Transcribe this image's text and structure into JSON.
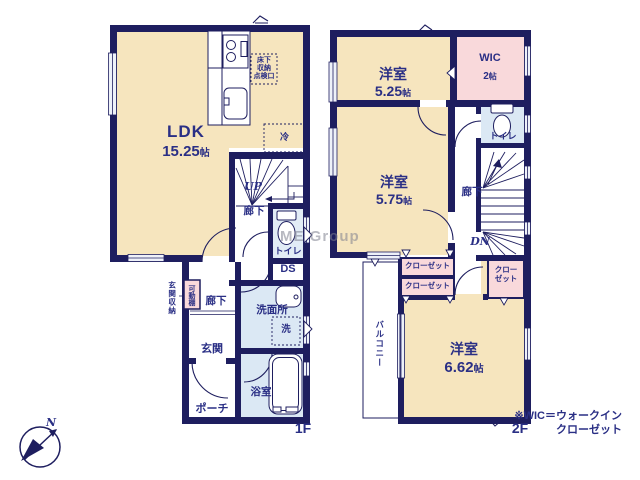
{
  "watermark": "ME Group",
  "compass": {
    "north": "N"
  },
  "note": {
    "line1": "※WIC＝ウォークイン",
    "line2": "クローゼット"
  },
  "colors": {
    "wall": "#1e1e5f",
    "room": "#f6e5be",
    "closet": "#f9d9db",
    "wet_area": "#dbe8f4",
    "label_text": "#2a2f85"
  },
  "floor1": {
    "label": "1F",
    "ldk_name": "LDK",
    "ldk_area": "15.25",
    "ldk_unit": "帖",
    "underfloor_l1": "床下",
    "underfloor_l2": "収納",
    "underfloor_l3": "点検口",
    "fridge": "冷",
    "stairs_up": "UP",
    "hall_upper": "廊下",
    "toilet": "トイレ",
    "duct": "DS",
    "washroom": "洗面所",
    "washer": "洗",
    "bath": "浴室",
    "entrance_storage": "玄関収納",
    "movable_shelf": "可動棚",
    "hall_lower": "廊下",
    "entrance": "玄関",
    "porch": "ポーチ"
  },
  "floor2": {
    "label": "2F",
    "room1_name": "洋室",
    "room1_area": "5.25",
    "room1_unit": "帖",
    "wic_name": "WIC",
    "wic_area": "2",
    "wic_unit": "帖",
    "toilet": "トイレ",
    "hall": "廊下",
    "stairs_down": "DN",
    "room2_name": "洋室",
    "room2_area": "5.75",
    "room2_unit": "帖",
    "closet1": "クローゼット",
    "closet2": "クローゼット",
    "closet3_l1": "クロー",
    "closet3_l2": "ゼット",
    "balcony": "バルコニー",
    "room3_name": "洋室",
    "room3_area": "6.62",
    "room3_unit": "帖"
  }
}
